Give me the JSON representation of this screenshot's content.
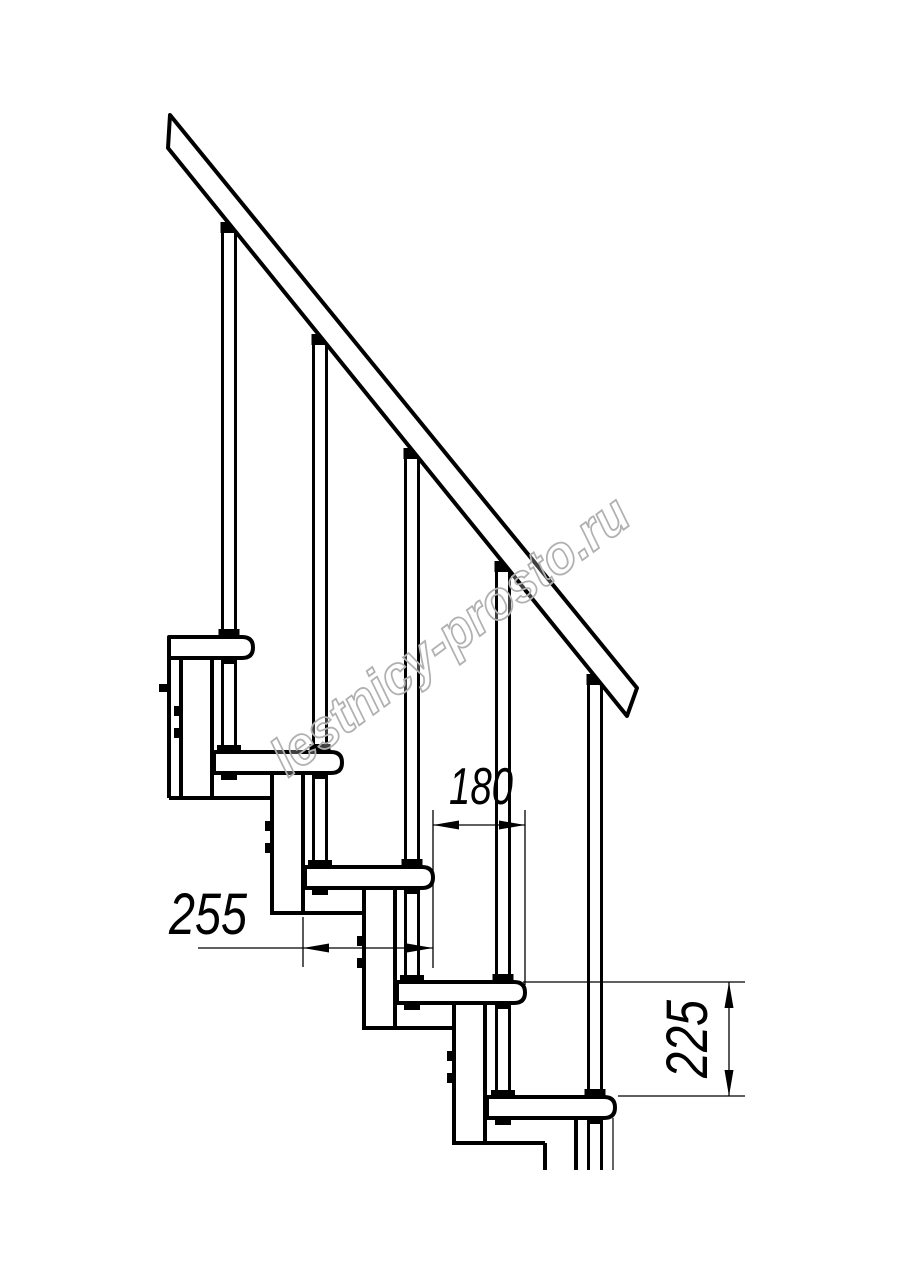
{
  "watermark": {
    "text": "lestnicy-prosto.ru"
  },
  "dimensions": {
    "going": {
      "label": "180"
    },
    "tread_depth": {
      "label": "255"
    },
    "rise": {
      "label": "225"
    }
  },
  "structure": {
    "treads_visible": 5,
    "balusters_visible": 5,
    "support_legs_visible": 4
  },
  "colors": {
    "line": "#000000",
    "watermark": "#b0b0b0",
    "background": "#ffffff"
  }
}
